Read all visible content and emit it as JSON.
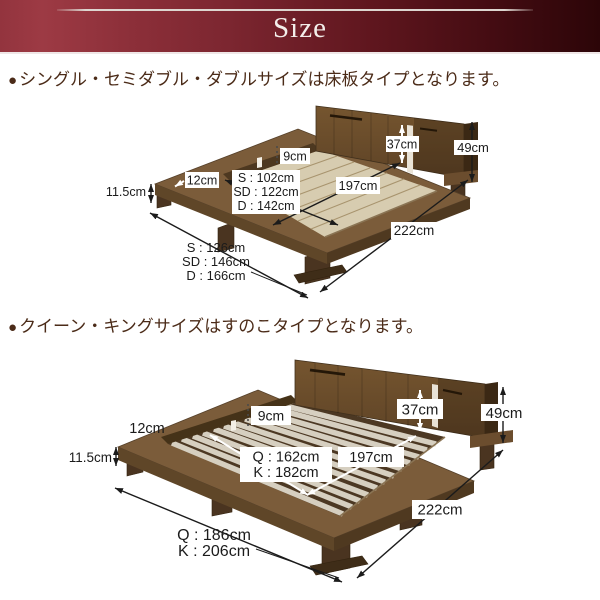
{
  "header": {
    "title": "Size"
  },
  "sections": [
    {
      "id": "floorboard",
      "bullet": "●",
      "note": "シングル・セミダブル・ダブルサイズは床板タイプとなります。",
      "dims": {
        "rim_width": "12cm",
        "rail_height": "9cm",
        "frame_height": "11.5cm",
        "headboard_height": "37cm",
        "total_height": "49cm",
        "inner_length": "197cm",
        "total_length": "222cm",
        "inner_widths": [
          "S : 102cm",
          "SD : 122cm",
          "D : 142cm"
        ],
        "outer_widths": [
          "S : 126cm",
          "SD : 146cm",
          "D : 166cm"
        ]
      }
    },
    {
      "id": "slat",
      "bullet": "●",
      "note": "クイーン・キングサイズはすのこタイプとなります。",
      "dims": {
        "rim_width": "12cm",
        "rail_height": "9cm",
        "frame_height": "11.5cm",
        "headboard_height": "37cm",
        "total_height": "49cm",
        "inner_length": "197cm",
        "total_length": "222cm",
        "inner_widths": [
          "Q : 162cm",
          "K : 182cm"
        ],
        "outer_widths": [
          "Q : 186cm",
          "K : 206cm"
        ]
      }
    }
  ],
  "palette": {
    "header_maroon_light": "#9d3a44",
    "header_maroon_dark": "#2c0508",
    "note_brown": "#4b2b18",
    "wood_top": "#7b5c3a",
    "wood_dark": "#4f3920",
    "floorboard_beige": "#d7ccb0",
    "slat_light": "#d6cfc0",
    "dim_text": "#1b1b1b"
  }
}
